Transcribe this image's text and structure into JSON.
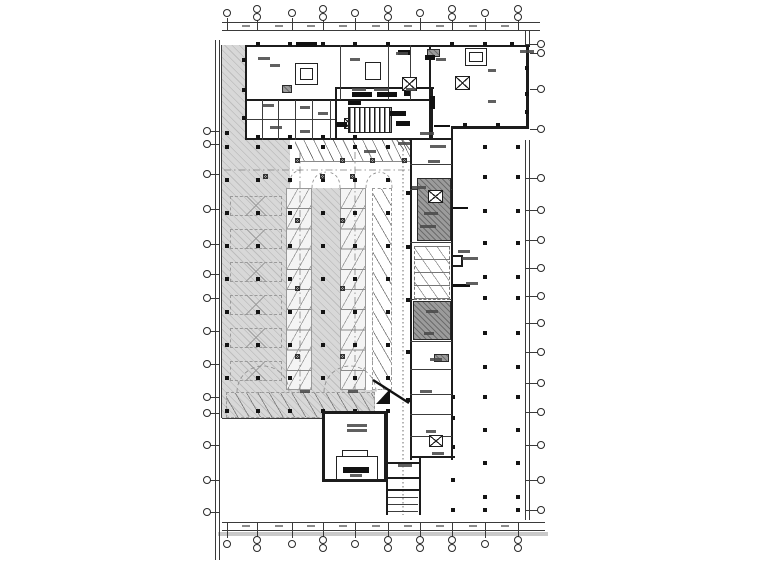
{
  "meta": {
    "title": "Basement garage electrical floor plan (CAD drawing, annotations illegible at source resolution)"
  },
  "colors": {
    "paper": "#ffffff",
    "wall": "#1c1c1c",
    "axis": "#3a3a3a",
    "garage_hatch_fill": "#d8d8d8",
    "garage_hatch_line": "#bdbdbd",
    "shaft_fill": "#9b9b9b",
    "equipment": "#111111",
    "bottom_band": "#c9c9c9",
    "annotation": "#4a4a4a"
  },
  "axis": {
    "top": {
      "y1": 22,
      "y2": 30,
      "x1": 222,
      "x2": 540,
      "bubbles": [
        [
          "s",
          227
        ],
        [
          "d",
          257
        ],
        [
          "s",
          292
        ],
        [
          "d",
          323
        ],
        [
          "s",
          355
        ],
        [
          "d",
          388
        ],
        [
          "s",
          420
        ],
        [
          "d",
          452
        ],
        [
          "s",
          485
        ],
        [
          "d",
          518
        ]
      ],
      "dash_xs": [
        242,
        275,
        307,
        339,
        372,
        404,
        436,
        469,
        501
      ],
      "dash_y": 25
    },
    "bottom": {
      "y1": 522,
      "y2": 530,
      "x1": 222,
      "x2": 545,
      "bubbles": [
        [
          "s",
          227
        ],
        [
          "d",
          257
        ],
        [
          "s",
          292
        ],
        [
          "d",
          323
        ],
        [
          "s",
          355
        ],
        [
          "d",
          388
        ],
        [
          "d",
          420
        ],
        [
          "d",
          452
        ],
        [
          "s",
          485
        ],
        [
          "d",
          518
        ]
      ],
      "dash_xs": [
        242,
        275,
        307,
        339,
        372,
        404,
        436,
        469,
        501
      ],
      "dash_y": 525,
      "gray_band": [
        218,
        532,
        330,
        4
      ]
    },
    "left": {
      "x1": 215,
      "x2": 219,
      "y1": 40,
      "y2": 560,
      "bubble_cx": 207,
      "ys": [
        131,
        144,
        174,
        209,
        244,
        274,
        298,
        331,
        364,
        397,
        413,
        445,
        480,
        512
      ]
    },
    "right": {
      "x1": 525,
      "x2": 529,
      "y1": 30,
      "y2": 520,
      "bubble_cx": 541,
      "ys": [
        44,
        53,
        89,
        129,
        178,
        210,
        240,
        268,
        296,
        323,
        352,
        383,
        412,
        445,
        480,
        510
      ]
    }
  },
  "garage_polygon": "222,45 248,45 248,132 290,132 290,188 366,188 366,390 375,390 375,418 222,418",
  "boundary_lines": [
    [
      221,
      45,
      1,
      373
    ],
    [
      222,
      418,
      154,
      1
    ]
  ],
  "building_bg": [
    [
      245,
      45,
      285,
      95
    ],
    [
      430,
      45,
      99,
      83
    ],
    [
      245,
      99,
      207,
      41
    ],
    [
      410,
      138,
      43,
      322
    ],
    [
      322,
      411,
      65,
      71
    ]
  ],
  "walls": [
    [
      245,
      45,
      285,
      2
    ],
    [
      245,
      45,
      2,
      95
    ],
    [
      245,
      138,
      208,
      2
    ],
    [
      429,
      45,
      2,
      95
    ],
    [
      526,
      45,
      3,
      84
    ],
    [
      453,
      126,
      76,
      3
    ],
    [
      335,
      87,
      99,
      2
    ],
    [
      335,
      87,
      2,
      53
    ],
    [
      431,
      87,
      2,
      53
    ],
    [
      245,
      99,
      186,
      2
    ],
    [
      410,
      138,
      2,
      322
    ],
    [
      451,
      126,
      2,
      274
    ],
    [
      451,
      394,
      2,
      66
    ],
    [
      410,
      456,
      45,
      2
    ],
    [
      322,
      411,
      65,
      3
    ],
    [
      322,
      411,
      3,
      71
    ],
    [
      322,
      479,
      65,
      3
    ],
    [
      384,
      411,
      3,
      71
    ],
    [
      386,
      413,
      2,
      102
    ],
    [
      419,
      458,
      2,
      57
    ],
    [
      386,
      462,
      34,
      2
    ],
    [
      386,
      477,
      34,
      2
    ],
    [
      386,
      489,
      34,
      2
    ],
    [
      453,
      255,
      10,
      2
    ],
    [
      453,
      265,
      10,
      2
    ],
    [
      461,
      255,
      2,
      12
    ]
  ],
  "partitions": {
    "v": [
      [
        340,
        45,
        55
      ],
      [
        388,
        45,
        55
      ],
      [
        410,
        45,
        55
      ],
      [
        262,
        100,
        40
      ],
      [
        278,
        100,
        40
      ],
      [
        295,
        100,
        40
      ],
      [
        312,
        100,
        40
      ],
      [
        330,
        100,
        40
      ]
    ],
    "h": [
      [
        245,
        119,
        90
      ],
      [
        410,
        164,
        42
      ],
      [
        410,
        189,
        42
      ],
      [
        410,
        242,
        42
      ],
      [
        410,
        299,
        42
      ],
      [
        410,
        341,
        42
      ],
      [
        410,
        369,
        42
      ],
      [
        410,
        394,
        42
      ],
      [
        410,
        414,
        42
      ],
      [
        410,
        436,
        42
      ],
      [
        388,
        497,
        30
      ],
      [
        388,
        504,
        30
      ],
      [
        388,
        511,
        30
      ]
    ]
  },
  "rooms": [
    [
      295,
      63,
      23,
      22
    ],
    [
      300,
      68,
      13,
      12
    ],
    [
      365,
      62,
      16,
      18
    ],
    [
      465,
      48,
      22,
      18
    ],
    [
      469,
      52,
      14,
      10
    ],
    [
      336,
      456,
      42,
      24
    ],
    [
      342,
      450,
      26,
      7
    ]
  ],
  "dark_shafts": [
    [
      417,
      178,
      34,
      63
    ],
    [
      413,
      301,
      38,
      39
    ],
    [
      427,
      49,
      13,
      8
    ],
    [
      434,
      354,
      15,
      8
    ],
    [
      282,
      85,
      10,
      8
    ]
  ],
  "elevators": [
    [
      428,
      190,
      15,
      13
    ],
    [
      429,
      435,
      14,
      12
    ],
    [
      455,
      76,
      15,
      14
    ],
    [
      402,
      77,
      15,
      14
    ],
    [
      344,
      118,
      12,
      11
    ]
  ],
  "equipment_bars": [
    [
      352,
      92,
      20,
      5
    ],
    [
      377,
      92,
      20,
      5
    ],
    [
      404,
      91,
      6,
      5
    ],
    [
      348,
      101,
      13,
      4
    ],
    [
      390,
      111,
      16,
      5
    ],
    [
      396,
      121,
      14,
      5
    ],
    [
      336,
      122,
      11,
      5
    ],
    [
      430,
      96,
      5,
      13
    ],
    [
      296,
      42,
      21,
      5
    ],
    [
      343,
      467,
      26,
      6
    ],
    [
      425,
      55,
      10,
      5
    ],
    [
      398,
      50,
      12,
      5
    ]
  ],
  "comb_grille": [
    348,
    107,
    44,
    26
  ],
  "stalls": {
    "top_rows": [
      [
        295,
        140,
        115,
        22
      ],
      [
        412,
        140,
        39,
        22
      ]
    ],
    "columns": [
      [
        286,
        188,
        26,
        202
      ],
      [
        340,
        188,
        26,
        202
      ]
    ],
    "angled": [
      [
        372,
        188,
        20,
        202
      ],
      [
        226,
        392,
        149,
        26
      ]
    ],
    "x_bands": [
      [
        230,
        196,
        52,
        20
      ],
      [
        230,
        229,
        52,
        20
      ],
      [
        230,
        262,
        52,
        20
      ],
      [
        230,
        295,
        52,
        20
      ],
      [
        230,
        328,
        52,
        20
      ],
      [
        230,
        361,
        52,
        20
      ]
    ],
    "core": [
      414,
      246,
      36,
      54
    ]
  },
  "dots": {
    "gridA": {
      "xs": [
        227,
        258,
        290,
        323,
        355,
        388
      ],
      "ys": [
        147,
        180,
        213,
        246,
        279,
        312,
        345,
        378,
        411
      ]
    },
    "gridB": {
      "xs": [
        485,
        518
      ],
      "ys": [
        147,
        177,
        211,
        243,
        277,
        298,
        333,
        367,
        397,
        430,
        463,
        497
      ]
    },
    "extra": [
      [
        227,
        133
      ],
      [
        408,
        193
      ],
      [
        408,
        247
      ],
      [
        408,
        300
      ],
      [
        408,
        352
      ],
      [
        408,
        400
      ],
      [
        453,
        397
      ],
      [
        453,
        418
      ],
      [
        453,
        447
      ],
      [
        453,
        480
      ],
      [
        453,
        510
      ],
      [
        485,
        510
      ],
      [
        518,
        510
      ],
      [
        355,
        447
      ]
    ]
  },
  "wall_ticks": [
    [
      258,
      44
    ],
    [
      290,
      44
    ],
    [
      323,
      44
    ],
    [
      355,
      44
    ],
    [
      388,
      44
    ],
    [
      452,
      44
    ],
    [
      485,
      44
    ],
    [
      512,
      44
    ],
    [
      527,
      68
    ],
    [
      527,
      94
    ],
    [
      527,
      112
    ],
    [
      465,
      125
    ],
    [
      498,
      125
    ],
    [
      244,
      60
    ],
    [
      244,
      90
    ],
    [
      244,
      118
    ],
    [
      258,
      137
    ],
    [
      290,
      137
    ],
    [
      323,
      137
    ],
    [
      355,
      137
    ]
  ],
  "cross_markers": [
    [
      297,
      160
    ],
    [
      342,
      160
    ],
    [
      372,
      160
    ],
    [
      404,
      160
    ],
    [
      265,
      176
    ],
    [
      322,
      176
    ],
    [
      352,
      176
    ],
    [
      297,
      220
    ],
    [
      342,
      220
    ],
    [
      297,
      288
    ],
    [
      342,
      288
    ],
    [
      297,
      356
    ],
    [
      342,
      356
    ]
  ],
  "leaders": [
    [
      453,
      207,
      15,
      2
    ],
    [
      453,
      284,
      17,
      3
    ],
    [
      434,
      125,
      16,
      2
    ]
  ],
  "annotation_smudges": [
    [
      258,
      57,
      12
    ],
    [
      270,
      64,
      10
    ],
    [
      350,
      58,
      10
    ],
    [
      396,
      52,
      12
    ],
    [
      520,
      50,
      14
    ],
    [
      436,
      58,
      10
    ],
    [
      488,
      69,
      8
    ],
    [
      488,
      100,
      8
    ],
    [
      262,
      104,
      12
    ],
    [
      300,
      106,
      10
    ],
    [
      318,
      112,
      10
    ],
    [
      352,
      88,
      14
    ],
    [
      374,
      88,
      14
    ],
    [
      406,
      88,
      10
    ],
    [
      270,
      126,
      12
    ],
    [
      300,
      130,
      10
    ],
    [
      420,
      132,
      14
    ],
    [
      430,
      145,
      16
    ],
    [
      428,
      160,
      12
    ],
    [
      424,
      212,
      14
    ],
    [
      420,
      225,
      16
    ],
    [
      458,
      250,
      12
    ],
    [
      462,
      257,
      16
    ],
    [
      426,
      310,
      12
    ],
    [
      424,
      332,
      10
    ],
    [
      430,
      358,
      12
    ],
    [
      347,
      424,
      20
    ],
    [
      347,
      429,
      20
    ],
    [
      350,
      474,
      12
    ],
    [
      398,
      464,
      14
    ],
    [
      426,
      430,
      10
    ],
    [
      432,
      452,
      12
    ],
    [
      300,
      390,
      10
    ],
    [
      348,
      390,
      10
    ],
    [
      420,
      390,
      12
    ],
    [
      364,
      150,
      12
    ],
    [
      398,
      142,
      12
    ],
    [
      412,
      186,
      14
    ],
    [
      466,
      282,
      12
    ]
  ],
  "svg_paths": [
    {
      "d": "M300,152 V392",
      "da": "7 3 1.5 3",
      "w": 0.8,
      "c": "#808080"
    },
    {
      "d": "M355,152 V392",
      "da": "7 3 1.5 3",
      "w": 0.8,
      "c": "#808080"
    },
    {
      "d": "M403,150 V515",
      "da": "1.5 2.5",
      "w": 0.9,
      "c": "#5e5e5e"
    },
    {
      "d": "M224,170 H410",
      "da": "7 3 1.5 3",
      "w": 0.8,
      "c": "#808080"
    },
    {
      "d": "M290,183 Q290,171 302,170",
      "da": "3 2.5",
      "w": 0.8,
      "c": "#8a8a8a"
    },
    {
      "d": "M312,188 Q312,174 326,172",
      "da": "3 2.5",
      "w": 0.8,
      "c": "#8a8a8a"
    },
    {
      "d": "M340,188 Q340,174 328,172",
      "da": "3 2.5",
      "w": 0.8,
      "c": "#8a8a8a"
    },
    {
      "d": "M366,188 Q366,174 380,172",
      "da": "3 2.5",
      "w": 0.8,
      "c": "#8a8a8a"
    },
    {
      "d": "M392,188 Q392,174 380,172",
      "da": "3 2.5",
      "w": 0.8,
      "c": "#8a8a8a"
    },
    {
      "d": "M237,392 A26,26 0 0 1 289,392",
      "da": "4 3",
      "w": 0.8,
      "c": "#8a8a8a"
    },
    {
      "d": "M324,392 A26,26 0 0 1 376,392",
      "da": "4 3",
      "w": 0.8,
      "c": "#8a8a8a"
    },
    {
      "d": "M373,380 L409,403",
      "da": "",
      "w": 2.4,
      "c": "#111"
    },
    {
      "d": "M376,404 L390,389 L390,404 Z",
      "fill": "#111"
    },
    {
      "d": "M394,128 L410,150 M400,128 L410,141 M394,136 L404,150",
      "da": "",
      "w": 0.8,
      "c": "#555"
    }
  ]
}
